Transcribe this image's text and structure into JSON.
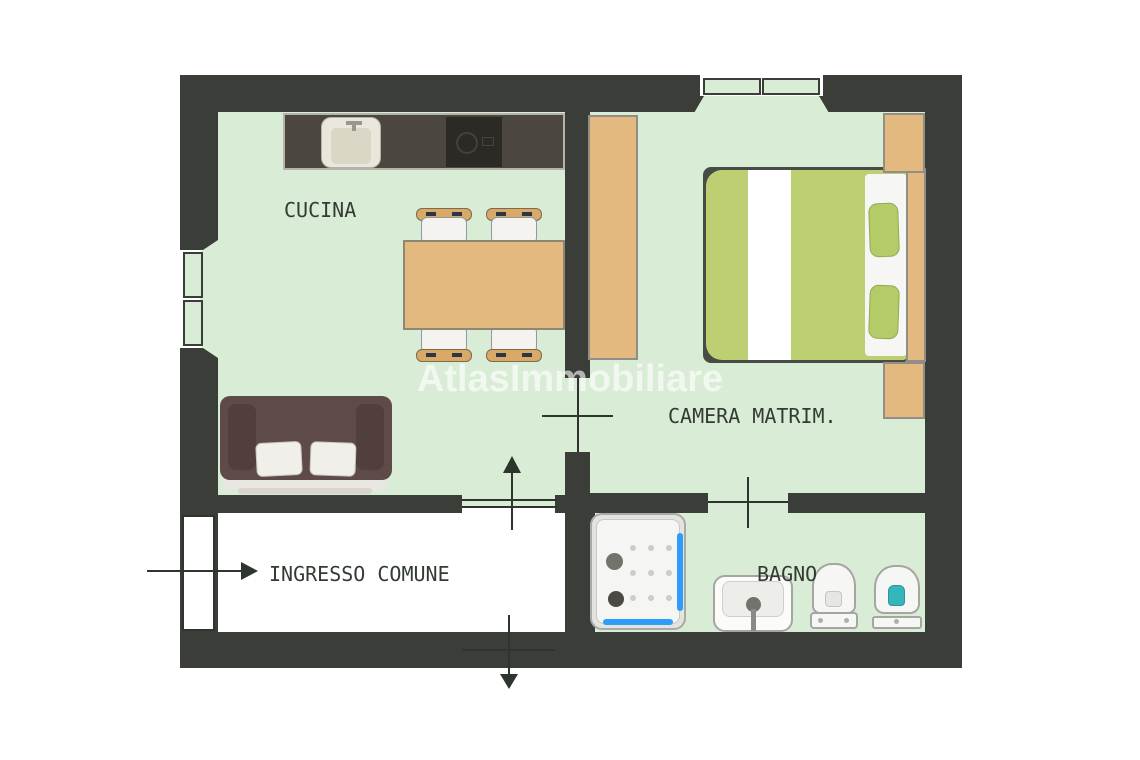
{
  "watermark": "AtlasImmobiliare",
  "rooms": {
    "cucina": {
      "label": "CUCINA"
    },
    "camera_matrimoniale": {
      "label": "CAMERA MATRIM."
    },
    "ingresso_comune": {
      "label": "INGRESSO COMUNE"
    },
    "bagno": {
      "label": "BAGNO"
    }
  },
  "furniture": {
    "cucina": [
      "kitchen-counter",
      "sink",
      "cooktop",
      "dining-table",
      "chair",
      "chair",
      "chair",
      "chair",
      "sofa"
    ],
    "camera_matrimoniale": [
      "wardrobe",
      "double-bed",
      "nightstand",
      "nightstand"
    ],
    "bagno": [
      "shower",
      "washbasin",
      "bidet",
      "toilet"
    ]
  },
  "symbols": {
    "entry_arrow_direction": "right",
    "kitchen_door_arrow_direction": "up",
    "exit_door_arrow_direction": "down",
    "window_count": 2,
    "interior_door_count": 2
  },
  "colors": {
    "background": "#ffffff",
    "wall": "#3a3d38",
    "room_floor": "#d9ecd5",
    "corridor_floor": "#ffffff",
    "wood_furniture": "#e3b97f",
    "kitchen_counter": "#4b463f",
    "sofa": "#5e4b49",
    "bed_duvet": "#bccf72",
    "shower_glass": "#2f9bfa",
    "toilet_accent": "#35b6bd",
    "label_text": "#333c33",
    "watermark": "rgba(255,255,255,0.62)"
  }
}
